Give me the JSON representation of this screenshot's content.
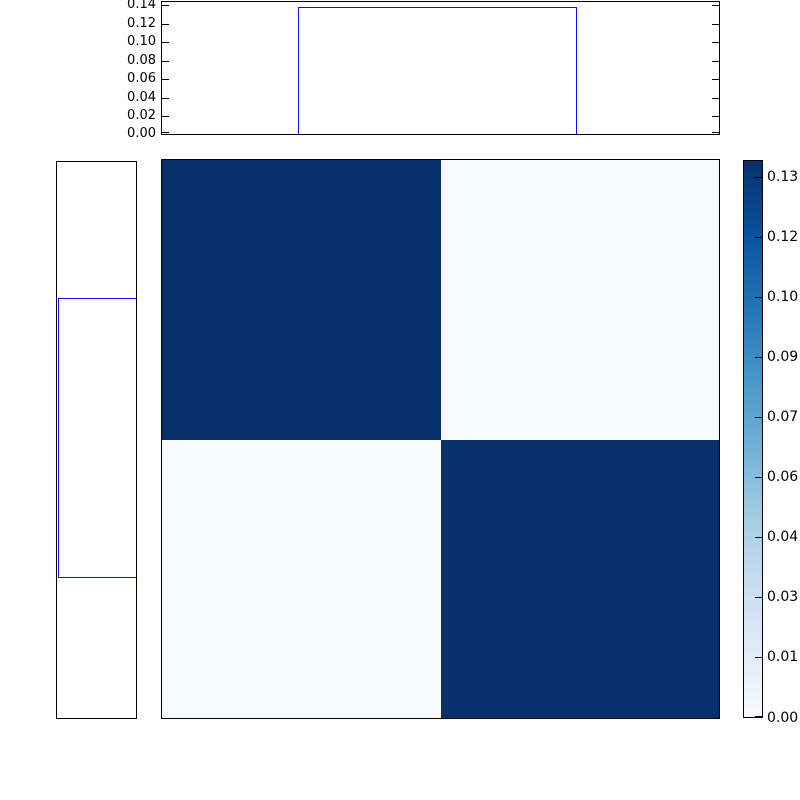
{
  "figure": {
    "background": "#ffffff",
    "description": "2x2 heatmap with top and left marginal step plots and a right colorbar"
  },
  "labels": {
    "top_yticks": [
      "0.14",
      "0.12",
      "0.10",
      "0.08",
      "0.06",
      "0.04",
      "0.02",
      "0.00"
    ],
    "colorbar_ticks": [
      "0.13",
      "0.12",
      "0.10",
      "0.09",
      "0.07",
      "0.06",
      "0.04",
      "0.03",
      "0.01",
      "0.00"
    ]
  },
  "colors": {
    "heatmap_high": "#08306b",
    "heatmap_low": "#f6f9fd",
    "step_line": "#0d0df0",
    "axis_border": "#000000",
    "colormap": "Blues"
  },
  "chart_data": [
    {
      "type": "line",
      "name": "top-marginal-step-function",
      "style": "step",
      "x_fraction": [
        0,
        0.247,
        0.247,
        0.748,
        0.748,
        1
      ],
      "y": [
        0,
        0,
        0.135,
        0.135,
        0,
        0
      ],
      "ylim": [
        0,
        0.145
      ],
      "yticks": [
        0.0,
        0.02,
        0.04,
        0.06,
        0.08,
        0.1,
        0.12,
        0.14
      ],
      "xticks": [],
      "grid": false,
      "line_color": "#0d0df0"
    },
    {
      "type": "line",
      "name": "left-marginal-step-function",
      "style": "step",
      "orientation": "vertical",
      "y_fraction": [
        0,
        0.247,
        0.247,
        0.748,
        0.748,
        1
      ],
      "value": [
        0,
        0,
        0.135,
        0.135,
        0,
        0
      ],
      "ticks": [],
      "grid": false,
      "line_color": "#0d0df0"
    },
    {
      "type": "heatmap",
      "name": "pairwise-block-matrix",
      "rows": 2,
      "cols": 2,
      "matrix": [
        [
          0.135,
          0.001
        ],
        [
          0.001,
          0.135
        ]
      ],
      "vmin": 0.0,
      "vmax": 0.14,
      "colormap": "Blues",
      "cell_colors": [
        [
          "#08306b",
          "#f6f9fd"
        ],
        [
          "#f6f9fd",
          "#08306b"
        ]
      ],
      "colorbar_ticklabels": [
        "0.13",
        "0.12",
        "0.10",
        "0.09",
        "0.07",
        "0.06",
        "0.04",
        "0.03",
        "0.01",
        "0.00"
      ],
      "colorbar_tickvalues": [
        0.135,
        0.12,
        0.105,
        0.09,
        0.075,
        0.06,
        0.045,
        0.03,
        0.015,
        0.0
      ],
      "colorbar_position": "right",
      "axis_ticks_visible": false
    }
  ]
}
